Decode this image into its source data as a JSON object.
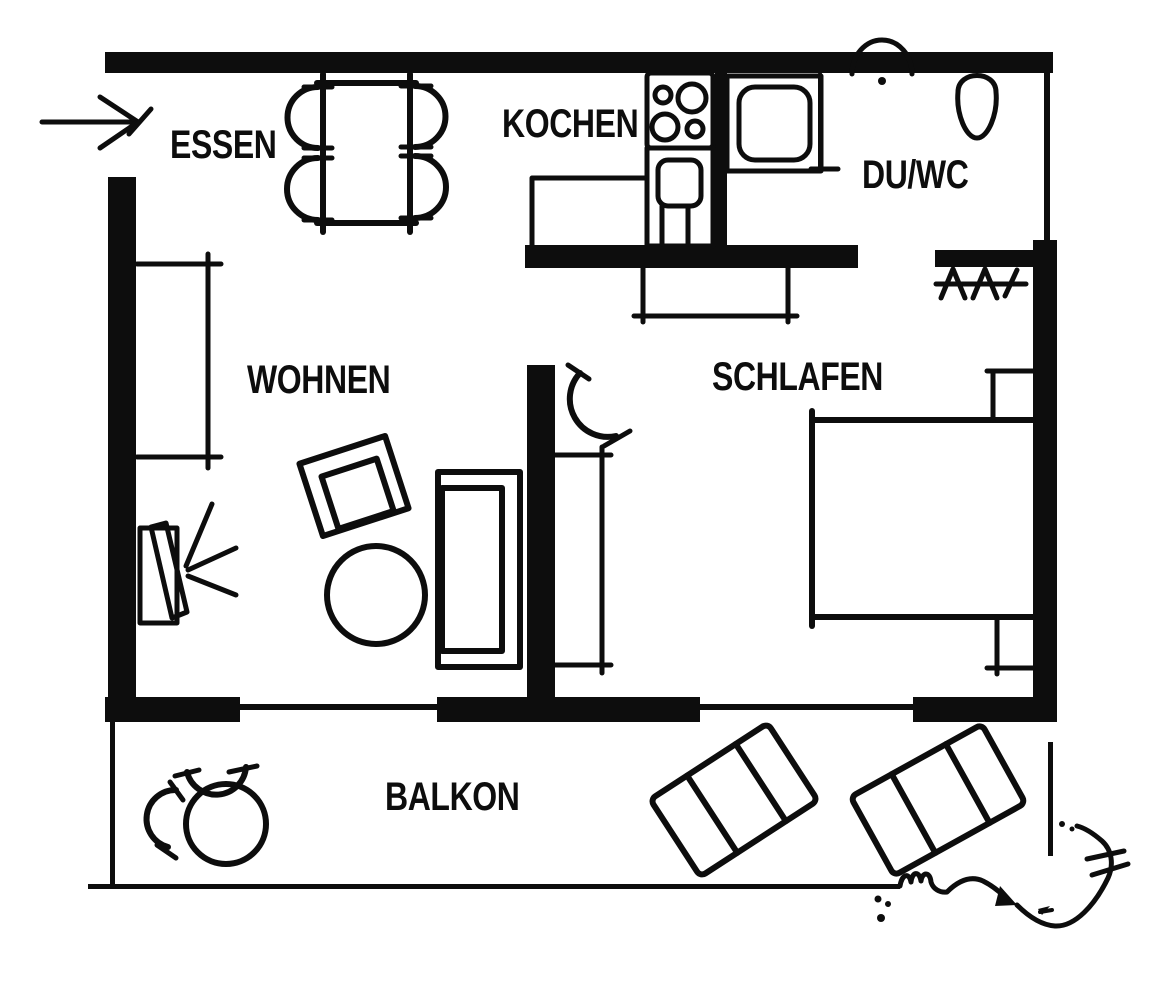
{
  "plan": {
    "background": "#ffffff",
    "ink": "#0d0d0d",
    "rooms": [
      {
        "id": "essen",
        "label": "ESSEN"
      },
      {
        "id": "kochen",
        "label": "KOCHEN"
      },
      {
        "id": "duwc",
        "label": "DU/WC"
      },
      {
        "id": "wohnen",
        "label": "WOHNEN"
      },
      {
        "id": "schlafen",
        "label": "SCHLAFEN"
      },
      {
        "id": "balkon",
        "label": "BALKON"
      }
    ],
    "icons": [
      "entrance-arrow-icon",
      "dining-table-icon",
      "chair-icon",
      "stove-icon",
      "kitchen-sink-icon",
      "shower-icon",
      "washbasin-icon",
      "toilet-icon",
      "wardrobe-hatch-icon",
      "tv-icon",
      "armchair-icon",
      "coffee-table-icon",
      "sofa-icon",
      "door-swing-icon",
      "bed-icon",
      "nightstand-icon",
      "balcony-table-icon",
      "sun-lounger-icon",
      "hand-drawn-arrow-icon"
    ]
  }
}
